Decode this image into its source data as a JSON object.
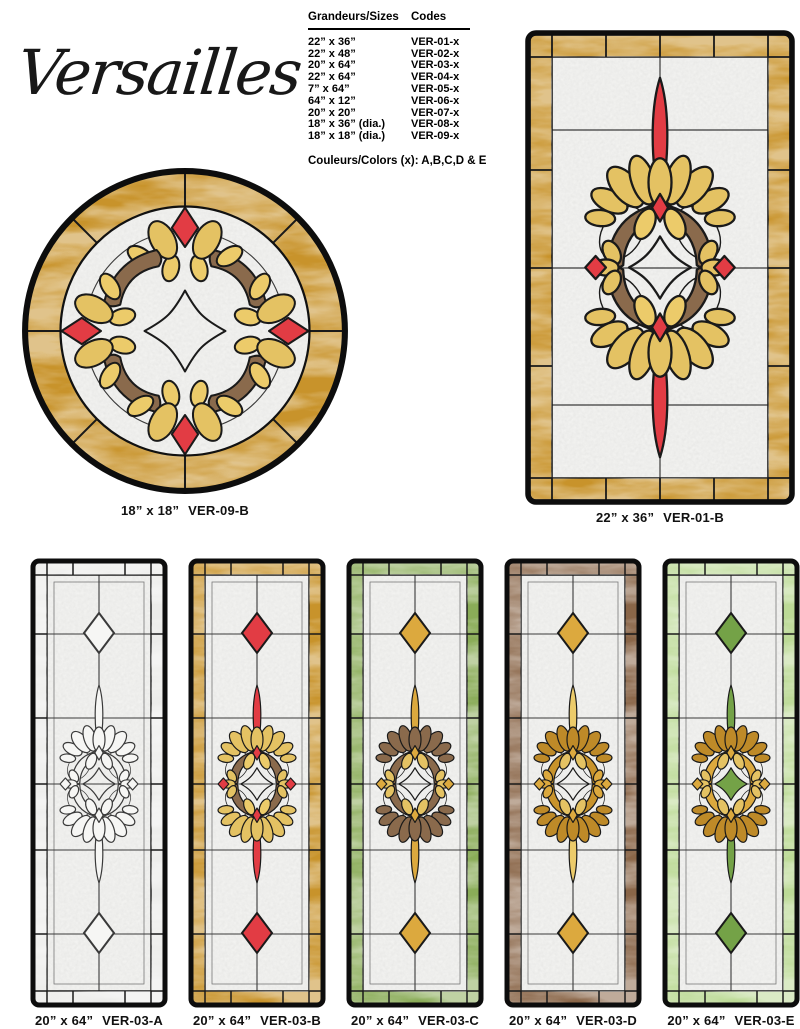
{
  "title": "Versailles",
  "table": {
    "header_sizes": "Grandeurs/Sizes",
    "header_codes": "Codes",
    "rows": [
      {
        "size": "22” x 36”",
        "code": "VER-01-x"
      },
      {
        "size": "22” x 48”",
        "code": "VER-02-x"
      },
      {
        "size": "20” x 64”",
        "code": "VER-03-x"
      },
      {
        "size": "22” x 64”",
        "code": "VER-04-x"
      },
      {
        "size": "7” x 64”",
        "code": "VER-05-x"
      },
      {
        "size": "64” x 12”",
        "code": "VER-06-x"
      },
      {
        "size": "20” x 20”",
        "code": "VER-07-x"
      },
      {
        "size": "18” x 36” (dia.)",
        "code": "VER-08-x"
      },
      {
        "size": "18” x 18” (dia.)",
        "code": "VER-09-x"
      }
    ],
    "colors_note": "Couleurs/Colors (x): A,B,C,D & E"
  },
  "windows": {
    "round": {
      "caption_size": "18” x 18”",
      "caption_code": "VER-09-B"
    },
    "large": {
      "caption_size": "22” x 36”",
      "caption_code": "VER-01-B"
    },
    "panels": [
      {
        "caption_size": "20” x 64”",
        "caption_code": "VER-03-A"
      },
      {
        "caption_size": "20” x 64”",
        "caption_code": "VER-03-B"
      },
      {
        "caption_size": "20” x 64”",
        "caption_code": "VER-03-C"
      },
      {
        "caption_size": "20” x 64”",
        "caption_code": "VER-03-D"
      },
      {
        "caption_size": "20” x 64”",
        "caption_code": "VER-03-E"
      }
    ]
  },
  "palette": {
    "amber": "#C8932B",
    "amber_leaf": "#BE8A28",
    "gold": "#E4C263",
    "gold_dark": "#DCA93E",
    "gold_light": "#ECCB6A",
    "red": "#E23C44",
    "brown": "#8A6A4C",
    "wood_border": "#8A6648",
    "green": "#8AAC58",
    "green_light": "#BCDA96",
    "green_accent": "#74A247",
    "clear_glass": "#F2F2F0",
    "lead": "#1A1A1A"
  }
}
